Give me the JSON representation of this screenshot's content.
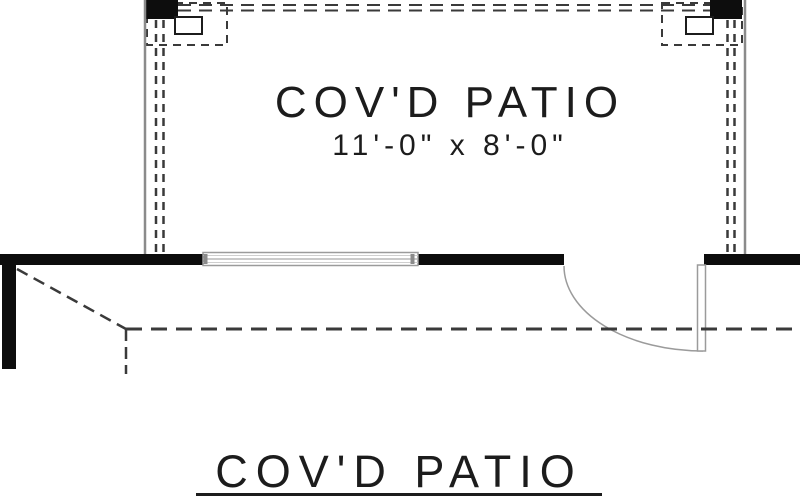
{
  "drawing": {
    "room": {
      "label": "COV'D PATIO",
      "dimensions": "11'-0\" x 8'-0\""
    },
    "title": "COV'D PATIO"
  },
  "icons": {
    "post_footing": "dashed-footing-square",
    "window": "window-symbol",
    "door": "door-swing-symbol"
  },
  "colors": {
    "wall_black": "#0d0d0d",
    "edge_gray": "#8b8b8b",
    "dash_dark": "#3a3a3a",
    "door_gray": "#9b9b9b",
    "text": "#1c1c1c",
    "background": "#ffffff"
  }
}
